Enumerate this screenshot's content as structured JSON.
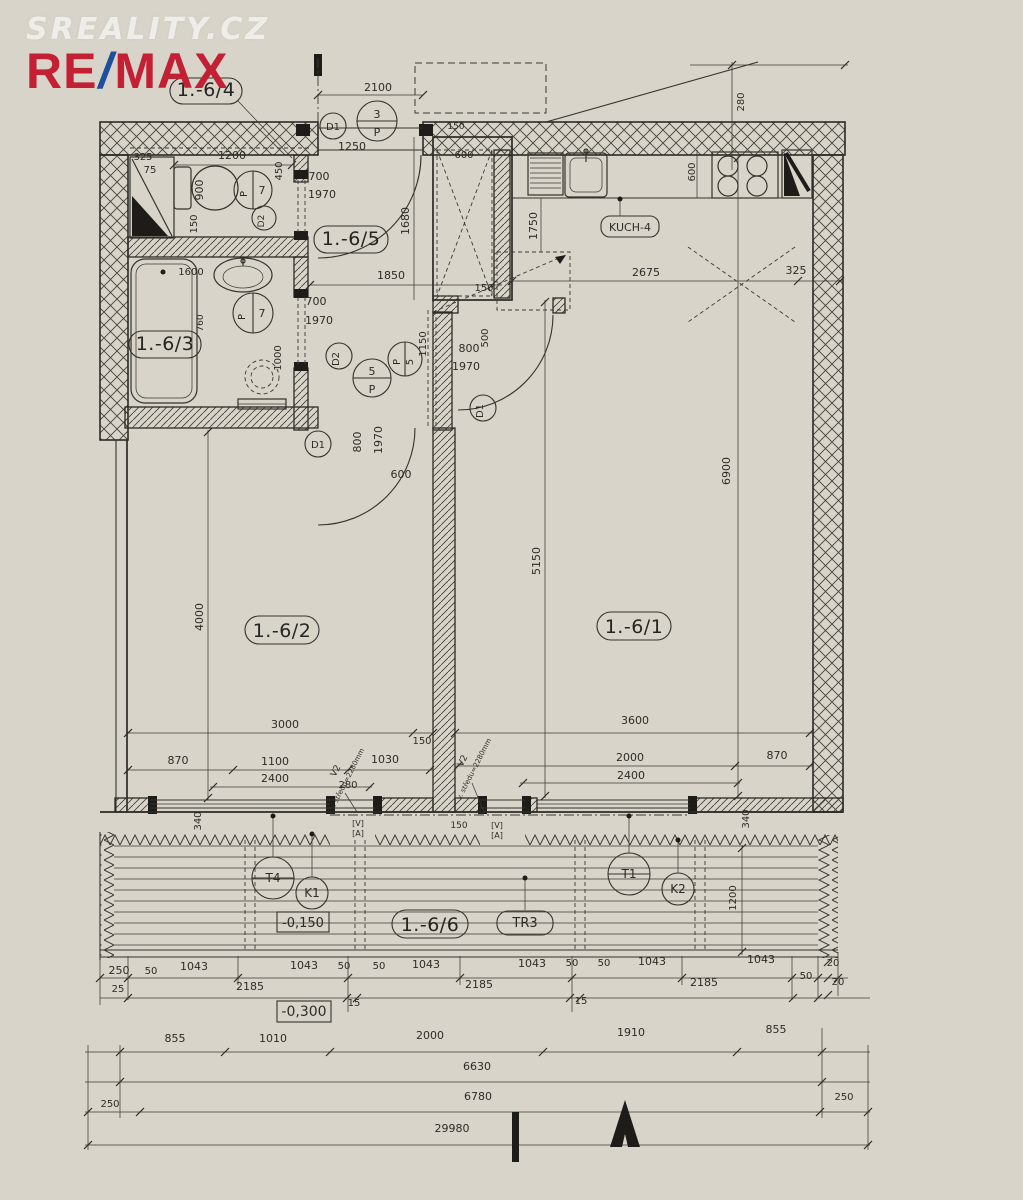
{
  "branding": {
    "watermark": "SREALITY.CZ",
    "re": "RE",
    "slash": "/",
    "max": "MAX"
  },
  "colors": {
    "paper": "#d8d4ca",
    "ink": "#34322c",
    "logo_red": "#c42033",
    "logo_blue": "#1d4f9c"
  },
  "room_labels": [
    {
      "t": "1.-6/4",
      "x": 206,
      "y": 96
    },
    {
      "t": "1.-6/5",
      "x": 351,
      "y": 245
    },
    {
      "t": "1.-6/3",
      "x": 165,
      "y": 350
    },
    {
      "t": "1.-6/2",
      "x": 282,
      "y": 637
    },
    {
      "t": "1.-6/1",
      "x": 634,
      "y": 633
    },
    {
      "t": "1.-6/6",
      "x": 430,
      "y": 931
    }
  ],
  "boxed_labels": [
    {
      "t": "KUCH-4",
      "x": 630,
      "y": 231,
      "s": 11
    },
    {
      "t": "TR3",
      "x": 525,
      "y": 927,
      "s": 13
    },
    {
      "t": "-0,150",
      "x": 303,
      "y": 927,
      "s": 13
    },
    {
      "t": "-0,300",
      "x": 304,
      "y": 1016,
      "s": 14
    }
  ],
  "circle_labels": [
    {
      "t": "D1",
      "x": 333,
      "y": 130,
      "s": 10
    },
    {
      "t": "3",
      "x": 377,
      "y": 118,
      "s": 11
    },
    {
      "t": "P",
      "x": 377,
      "y": 136,
      "s": 11
    },
    {
      "t": "P",
      "x": 247,
      "y": 194,
      "s": 10,
      "rot": -90
    },
    {
      "t": "7",
      "x": 262,
      "y": 194,
      "s": 11
    },
    {
      "t": "D2",
      "x": 264,
      "y": 221,
      "s": 9,
      "rot": -90
    },
    {
      "t": "P",
      "x": 245,
      "y": 317,
      "s": 10,
      "rot": -90
    },
    {
      "t": "7",
      "x": 262,
      "y": 317,
      "s": 11
    },
    {
      "t": "D2",
      "x": 339,
      "y": 359,
      "s": 10,
      "rot": -90
    },
    {
      "t": "5",
      "x": 372,
      "y": 375,
      "s": 11
    },
    {
      "t": "P",
      "x": 372,
      "y": 393,
      "s": 11
    },
    {
      "t": "P",
      "x": 400,
      "y": 362,
      "s": 10,
      "rot": -90
    },
    {
      "t": "5",
      "x": 413,
      "y": 362,
      "s": 10,
      "rot": -90
    },
    {
      "t": "D1",
      "x": 318,
      "y": 448,
      "s": 10
    },
    {
      "t": "D1",
      "x": 483,
      "y": 411,
      "s": 10,
      "rot": -90
    },
    {
      "t": "T4",
      "x": 273,
      "y": 882,
      "s": 12
    },
    {
      "t": "K1",
      "x": 312,
      "y": 897,
      "s": 12
    },
    {
      "t": "T1",
      "x": 629,
      "y": 878,
      "s": 12
    },
    {
      "t": "K2",
      "x": 678,
      "y": 893,
      "s": 12
    }
  ],
  "dims": [
    {
      "t": "2100",
      "x": 378,
      "y": 91
    },
    {
      "t": "1250",
      "x": 352,
      "y": 150
    },
    {
      "t": "150",
      "x": 456,
      "y": 129,
      "s": 9
    },
    {
      "t": "600",
      "x": 464,
      "y": 158,
      "s": 10
    },
    {
      "t": "325",
      "x": 143,
      "y": 160,
      "s": 10
    },
    {
      "t": "75",
      "x": 150,
      "y": 173,
      "s": 10
    },
    {
      "t": "1200",
      "x": 232,
      "y": 159
    },
    {
      "t": "450",
      "x": 282,
      "y": 171,
      "s": 10,
      "rot": -90
    },
    {
      "t": "900",
      "x": 203,
      "y": 190,
      "rot": -90
    },
    {
      "t": "150",
      "x": 197,
      "y": 224,
      "s": 10,
      "rot": -90
    },
    {
      "t": "700",
      "x": 319,
      "y": 180
    },
    {
      "t": "1970",
      "x": 322,
      "y": 198
    },
    {
      "t": "1680",
      "x": 409,
      "y": 221,
      "rot": -90
    },
    {
      "t": "600",
      "x": 695,
      "y": 172,
      "s": 10,
      "rot": -90
    },
    {
      "t": "1750",
      "x": 537,
      "y": 226,
      "rot": -90
    },
    {
      "t": "2675",
      "x": 646,
      "y": 276
    },
    {
      "t": "325",
      "x": 796,
      "y": 274
    },
    {
      "t": "1850",
      "x": 391,
      "y": 279
    },
    {
      "t": "150",
      "x": 484,
      "y": 291,
      "s": 10
    },
    {
      "t": "280",
      "x": 744,
      "y": 102,
      "s": 10,
      "rot": -90
    },
    {
      "t": "1600",
      "x": 191,
      "y": 275,
      "s": 10
    },
    {
      "t": "700",
      "x": 316,
      "y": 305
    },
    {
      "t": "1970",
      "x": 319,
      "y": 324
    },
    {
      "t": "760",
      "x": 203,
      "y": 323,
      "s": 9,
      "rot": -90
    },
    {
      "t": "1000",
      "x": 281,
      "y": 358,
      "s": 10,
      "rot": -90
    },
    {
      "t": "1150",
      "x": 426,
      "y": 344,
      "s": 10,
      "rot": -90
    },
    {
      "t": "800",
      "x": 469,
      "y": 352
    },
    {
      "t": "1970",
      "x": 466,
      "y": 370
    },
    {
      "t": "500",
      "x": 488,
      "y": 338,
      "s": 10,
      "rot": -90
    },
    {
      "t": "800",
      "x": 361,
      "y": 442,
      "rot": -90
    },
    {
      "t": "1970",
      "x": 382,
      "y": 440,
      "rot": -90
    },
    {
      "t": "600",
      "x": 401,
      "y": 478
    },
    {
      "t": "4000",
      "x": 203,
      "y": 617,
      "rot": -90
    },
    {
      "t": "5150",
      "x": 540,
      "y": 561,
      "rot": -90
    },
    {
      "t": "6900",
      "x": 730,
      "y": 471,
      "rot": -90
    },
    {
      "t": "3000",
      "x": 285,
      "y": 728
    },
    {
      "t": "3600",
      "x": 635,
      "y": 724
    },
    {
      "t": "150",
      "x": 422,
      "y": 744,
      "s": 10
    },
    {
      "t": "870",
      "x": 178,
      "y": 764
    },
    {
      "t": "1100",
      "x": 275,
      "y": 765
    },
    {
      "t": "1030",
      "x": 385,
      "y": 763
    },
    {
      "t": "2400",
      "x": 275,
      "y": 782
    },
    {
      "t": "280",
      "x": 348,
      "y": 788,
      "s": 10
    },
    {
      "t": "2000",
      "x": 630,
      "y": 761
    },
    {
      "t": "2400",
      "x": 631,
      "y": 779
    },
    {
      "t": "870",
      "x": 777,
      "y": 759
    },
    {
      "t": "340",
      "x": 201,
      "y": 821,
      "s": 10,
      "rot": -90
    },
    {
      "t": "340",
      "x": 749,
      "y": 819,
      "s": 10,
      "rot": -90
    },
    {
      "t": "150",
      "x": 459,
      "y": 828,
      "s": 9
    },
    {
      "t": "1200",
      "x": 736,
      "y": 898,
      "s": 10,
      "rot": -90
    },
    {
      "t": "15",
      "x": 354,
      "y": 1006,
      "s": 10
    },
    {
      "t": "15",
      "x": 581,
      "y": 1004,
      "s": 10
    }
  ],
  "chains": [
    {
      "t": "250",
      "x": 119,
      "y": 974
    },
    {
      "t": "50",
      "x": 151,
      "y": 974,
      "s": 10
    },
    {
      "t": "1043",
      "x": 194,
      "y": 970
    },
    {
      "t": "1043",
      "x": 304,
      "y": 969
    },
    {
      "t": "50",
      "x": 344,
      "y": 969,
      "s": 10
    },
    {
      "t": "50",
      "x": 379,
      "y": 969,
      "s": 10
    },
    {
      "t": "1043",
      "x": 426,
      "y": 968
    },
    {
      "t": "1043",
      "x": 532,
      "y": 967
    },
    {
      "t": "50",
      "x": 572,
      "y": 966,
      "s": 10
    },
    {
      "t": "50",
      "x": 604,
      "y": 966,
      "s": 10
    },
    {
      "t": "1043",
      "x": 652,
      "y": 965
    },
    {
      "t": "1043",
      "x": 761,
      "y": 963
    },
    {
      "t": "50",
      "x": 806,
      "y": 979,
      "s": 10
    },
    {
      "t": "20",
      "x": 833,
      "y": 966,
      "s": 10
    },
    {
      "t": "20",
      "x": 838,
      "y": 985,
      "s": 10
    },
    {
      "t": "25",
      "x": 118,
      "y": 992,
      "s": 10
    },
    {
      "t": "2185",
      "x": 250,
      "y": 990
    },
    {
      "t": "2185",
      "x": 479,
      "y": 988
    },
    {
      "t": "2185",
      "x": 704,
      "y": 986
    },
    {
      "t": "855",
      "x": 175,
      "y": 1042
    },
    {
      "t": "1010",
      "x": 273,
      "y": 1042
    },
    {
      "t": "2000",
      "x": 430,
      "y": 1039
    },
    {
      "t": "1910",
      "x": 631,
      "y": 1036
    },
    {
      "t": "855",
      "x": 776,
      "y": 1033
    },
    {
      "t": "6630",
      "x": 477,
      "y": 1070
    },
    {
      "t": "250",
      "x": 110,
      "y": 1107,
      "s": 10
    },
    {
      "t": "6780",
      "x": 478,
      "y": 1100
    },
    {
      "t": "250",
      "x": 844,
      "y": 1100,
      "s": 10
    },
    {
      "t": "29980",
      "x": 452,
      "y": 1132
    }
  ],
  "notes": [
    {
      "t": "V2",
      "x": 338,
      "y": 772,
      "s": 9,
      "rot": -63
    },
    {
      "t": "v. středu=2280mm",
      "x": 349,
      "y": 780,
      "s": 7,
      "rot": -63
    },
    {
      "t": "V2",
      "x": 465,
      "y": 762,
      "s": 9,
      "rot": -63
    },
    {
      "t": "v. středu=2280mm",
      "x": 476,
      "y": 770,
      "s": 7,
      "rot": -63
    }
  ],
  "door_window_marks": [
    {
      "t": "[V]",
      "x": 358,
      "y": 826,
      "s": 8
    },
    {
      "t": "[A]",
      "x": 358,
      "y": 836,
      "s": 8
    },
    {
      "t": "[V]",
      "x": 497,
      "y": 828,
      "s": 8
    },
    {
      "t": "[A]",
      "x": 497,
      "y": 838,
      "s": 8
    }
  ]
}
